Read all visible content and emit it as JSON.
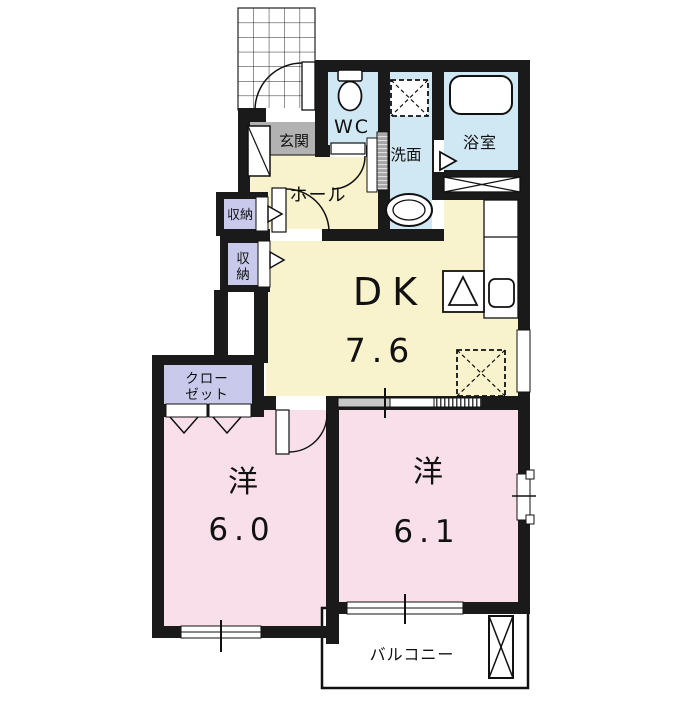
{
  "colors": {
    "wall": "#1a1a1a",
    "dk_floor": "#f8f2cd",
    "bedroom_floor": "#f9dfe9",
    "water_floor": "#cfe8f4",
    "storage_floor": "#c9c9ec",
    "entrance_floor": "#b2b2b2",
    "balcony_floor": "#ffffff"
  },
  "rooms": {
    "entrance": {
      "label": "玄関"
    },
    "toilet": {
      "label": "WC"
    },
    "washroom": {
      "label": "洗面"
    },
    "bathroom": {
      "label": "浴室"
    },
    "hall": {
      "label": "ホール"
    },
    "storage_upper": {
      "label": "収納"
    },
    "storage_lower": {
      "char1": "収",
      "char2": "納"
    },
    "dining_kitchen": {
      "label": "DK",
      "size": "7.6"
    },
    "closet": {
      "line1": "クロー",
      "line2": "ゼット"
    },
    "bedroom_left": {
      "label": "洋",
      "size": "6.0"
    },
    "bedroom_right": {
      "label": "洋",
      "size": "6.1"
    },
    "balcony": {
      "label": "バルコニー"
    }
  }
}
